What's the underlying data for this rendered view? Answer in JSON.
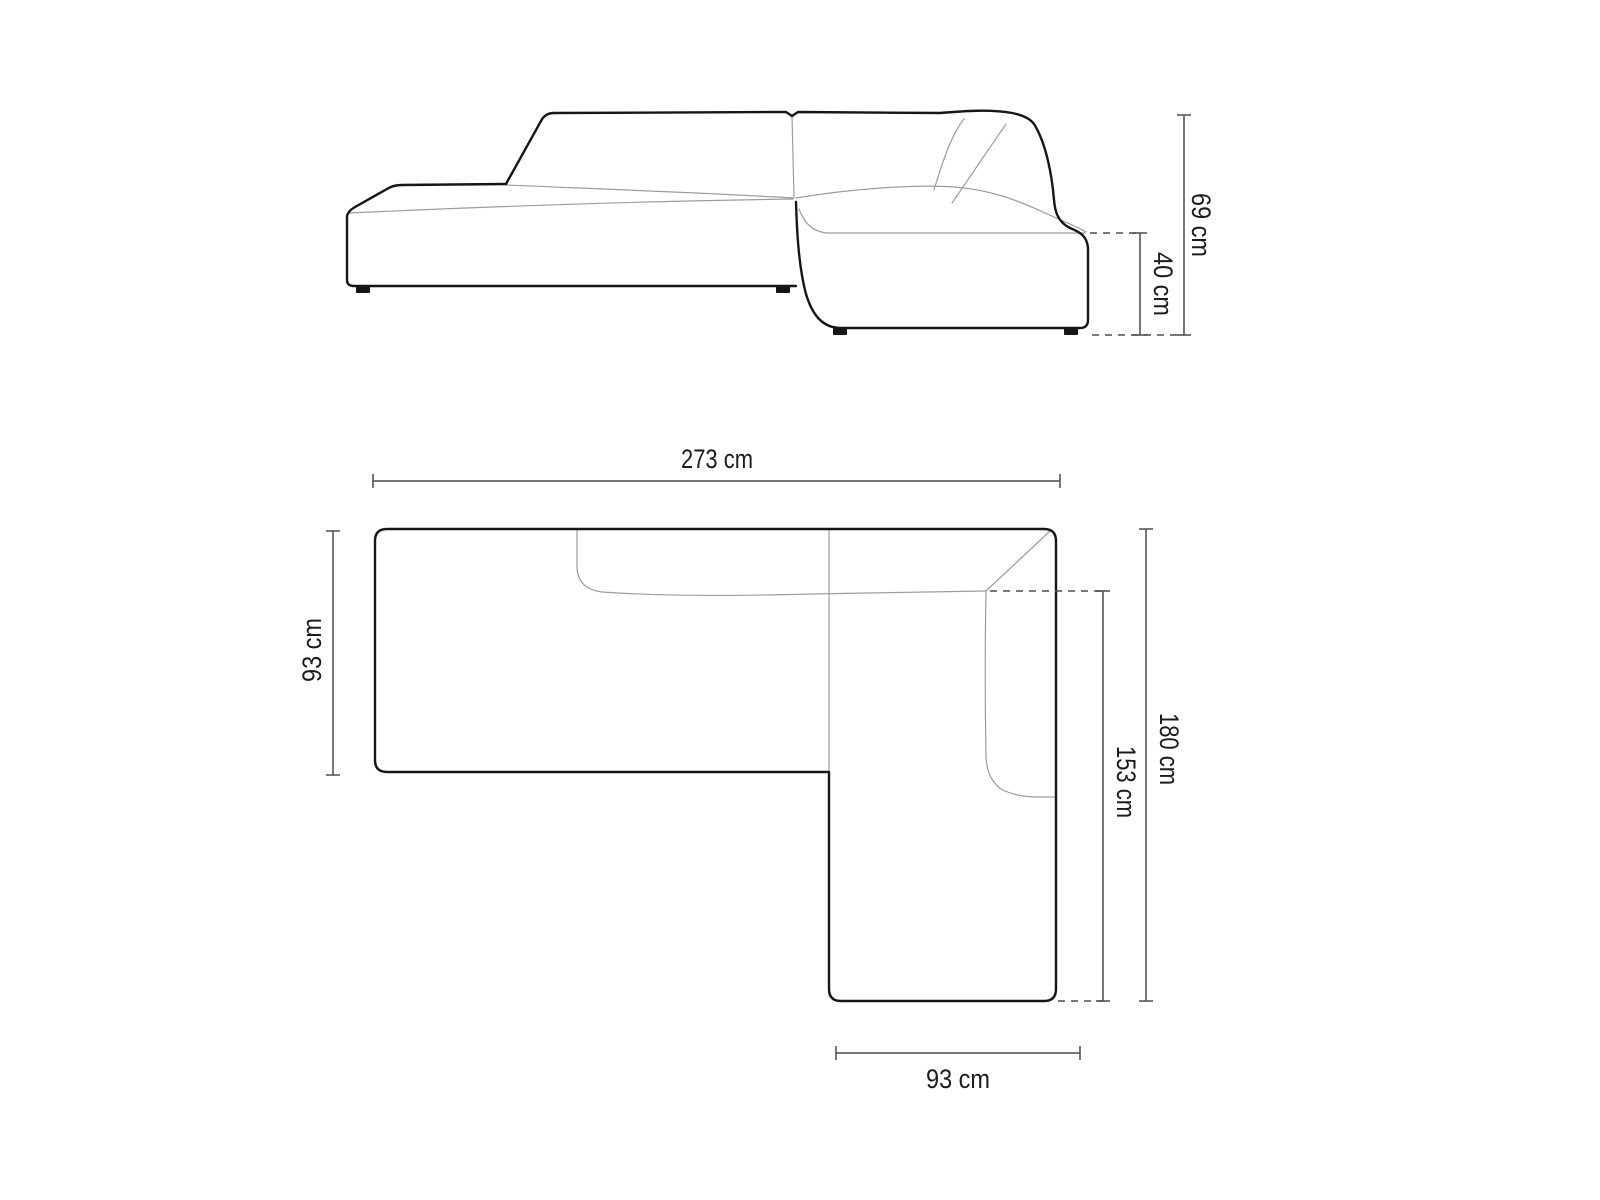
{
  "diagram": {
    "type": "furniture-dimension-drawing",
    "subject": "corner sofa with chaise, side elevation and top plan view",
    "unit": "cm",
    "colors": {
      "background": "#ffffff",
      "outline_dark": "#161616",
      "outline_light": "#9d9d9d",
      "dimension_line": "#4c4c4c",
      "label_text": "#1c1c1c"
    },
    "dimensions": {
      "overall_height": "69 cm",
      "seat_height": "40 cm",
      "overall_width": "273 cm",
      "left_section_depth": "93 cm",
      "overall_depth": "180 cm",
      "chaise_inner_length": "153 cm",
      "chaise_width": "93 cm"
    },
    "views": {
      "side_view": {
        "name": "side elevation",
        "dimension_labels": [
          "69 cm",
          "40 cm"
        ]
      },
      "plan_view": {
        "name": "top plan",
        "dimension_labels": [
          "273 cm",
          "93 cm",
          "180 cm",
          "153 cm",
          "93 cm"
        ]
      }
    }
  }
}
